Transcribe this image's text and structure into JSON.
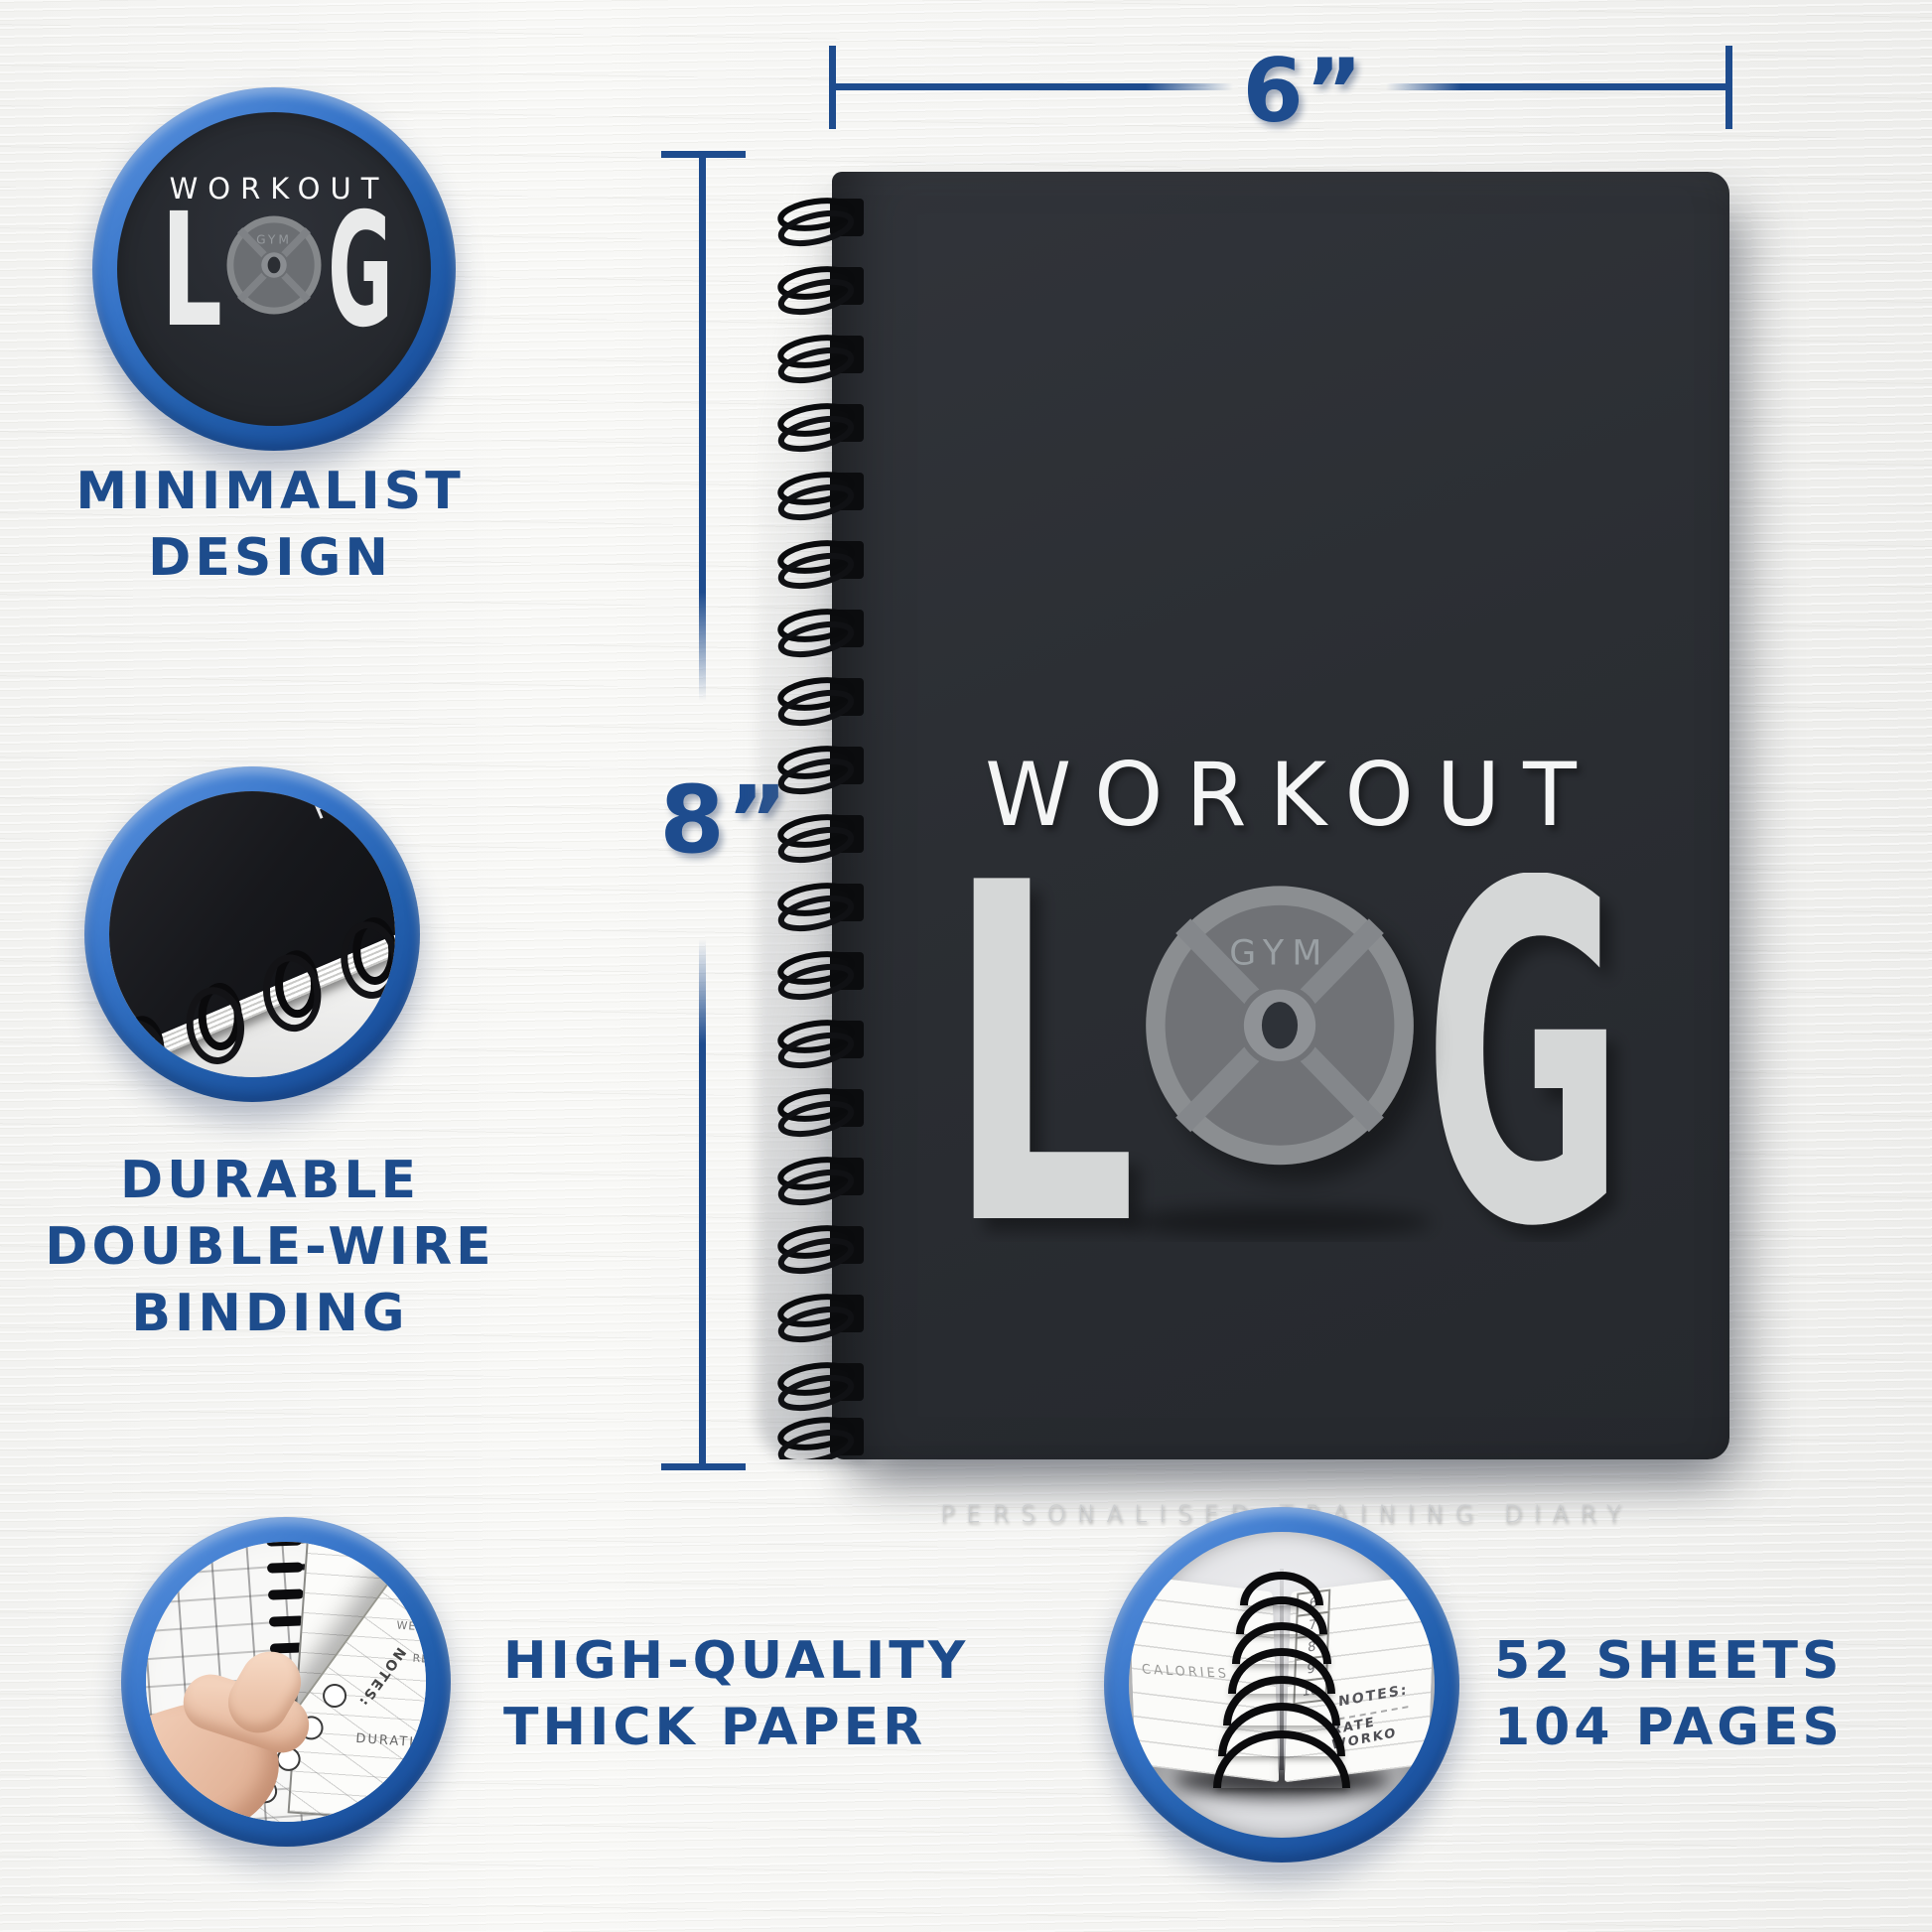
{
  "colors": {
    "accent_navy": "#1d4c8c",
    "dimension_line": "#1e4c8e",
    "ring_blue": "#2f6fc2",
    "cover_charcoal": "#2b2e33",
    "plate_gray": "#8b8e91",
    "log_letter_gray": "#d5d7d7",
    "background": "#f5f5f3"
  },
  "dimensions": {
    "width_label": "6”",
    "height_label": "8”"
  },
  "cover": {
    "title": "WORKOUT",
    "log_left": "L",
    "log_right": "G",
    "plate_label": "GYM",
    "tagline": "PERSONALISED TRAINING DIARY"
  },
  "badge_logo": {
    "title": "WORKOUT",
    "log_left": "L",
    "log_right": "G",
    "plate_label": "GYM"
  },
  "badge_binding": {
    "cover_text": "PER"
  },
  "badge_paper": {
    "notes": "NOTES:",
    "duration": "DURATION",
    "weight": "WEIGHT",
    "reps": "REPS",
    "rate": "RATE WORKOUT:"
  },
  "badge_sheets": {
    "calories": "CALORIES",
    "notes": "NOTES:",
    "rate": "RATE WORKO",
    "scale": [
      "6",
      "7",
      "8",
      "9",
      "10"
    ]
  },
  "features": {
    "minimalist": {
      "line1": "MINIMALIST",
      "line2": "DESIGN"
    },
    "binding": {
      "line1": "DURABLE",
      "line2": "DOUBLE-WIRE",
      "line3": "BINDING"
    },
    "paper": {
      "line1": "HIGH-QUALITY",
      "line2": "THICK PAPER"
    },
    "sheets": {
      "line1": "52 SHEETS",
      "line2": "104 PAGES"
    }
  }
}
